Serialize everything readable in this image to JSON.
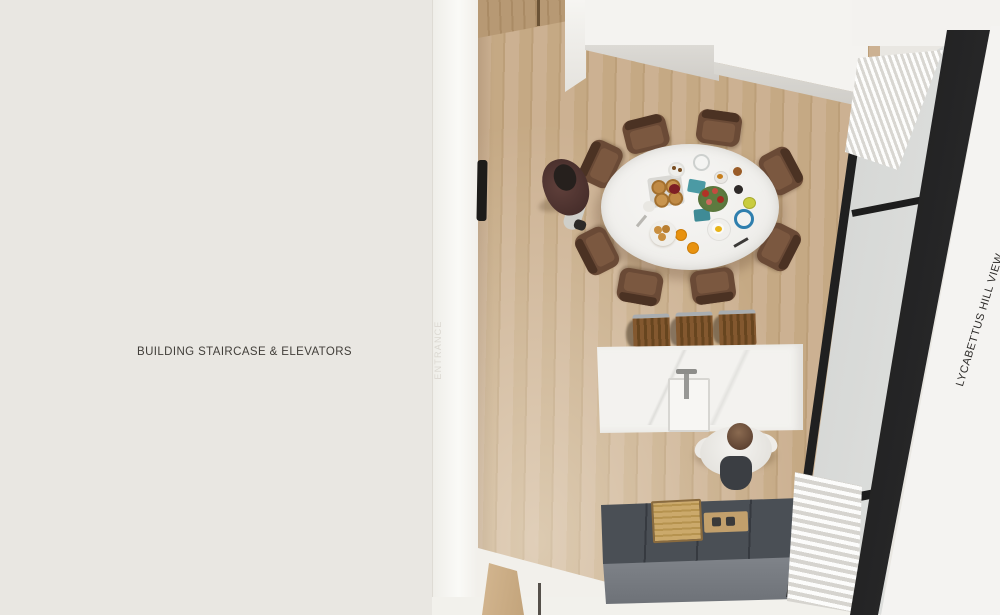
{
  "annotations": {
    "building_area_label": "BUILDING STAIRCASE & ELEVATORS",
    "entrance_label": "ENTRANCE",
    "view_label": "LYCABETTUS HILL VIEW"
  },
  "palette": {
    "left_area_bg": "#e9e7e2",
    "entrance_strip": "#f8f7f4",
    "wood_floor": "#c7ac8a",
    "wall_white": "#f4f3f0",
    "window_frame_black": "#222222",
    "window_glass": "#d8dad8",
    "counter_top": "#4a4f55",
    "counter_front": "#7c8086",
    "island_marble": "#f3f2ef",
    "chair_wood": "#6a4a36",
    "stool_wood": "#7d5531",
    "accent_orange_juice": "#e8920f",
    "accent_blue_cup": "#2f7fae",
    "accent_flower_red": "#b23226",
    "accent_leaf_green": "#5d7a3f"
  },
  "scene_objects": [
    "wood-floor",
    "entrance-door",
    "door-handle",
    "dining-table",
    "dining-chairs-x8",
    "breakfast-setting",
    "kitchen-island",
    "island-sink",
    "bar-stools-x3",
    "kitchen-counter",
    "cutting-board",
    "cooktop",
    "standing-person",
    "seated-person",
    "window-wall",
    "curtain-top",
    "curtain-bottom"
  ]
}
